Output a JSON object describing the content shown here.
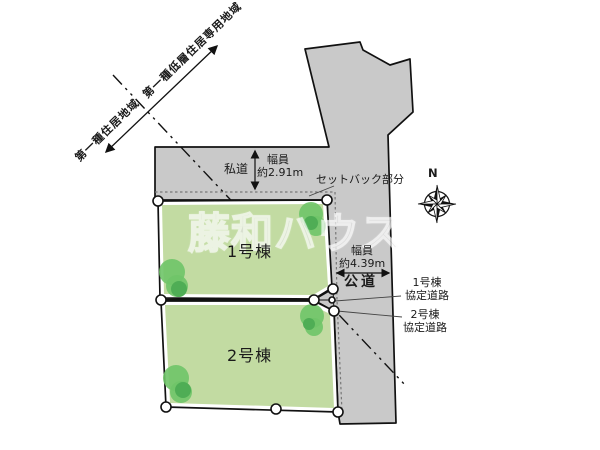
{
  "plan": {
    "watermark": "藤和ハウス",
    "compass": {
      "north_label": "N"
    },
    "zoning": {
      "district_left": "第一種住居地域",
      "district_right": "第一種低層住居専用地域"
    },
    "private_road": {
      "name": "私道",
      "width_label": "幅員",
      "width_value": "約2.91m"
    },
    "public_road": {
      "name": "公道",
      "width_label": "幅員",
      "width_value": "約4.39m"
    },
    "setback": {
      "label": "セットバック部分"
    },
    "agreement_roads": [
      {
        "line1": "1号棟",
        "line2": "協定道路"
      },
      {
        "line1": "2号棟",
        "line2": "協定道路"
      }
    ],
    "lots": [
      {
        "label": "1号棟"
      },
      {
        "label": "2号棟"
      }
    ],
    "colors": {
      "road_fill": "#c9c9c9",
      "outline": "#111111",
      "lot_fill": "#c2dba2",
      "tree_fill": "#6fc468",
      "tree_inner_fill": "#4fad55",
      "setback_line": "#777777",
      "label_text": "#1a1a1a",
      "watermark": "#e3e3e3"
    }
  }
}
